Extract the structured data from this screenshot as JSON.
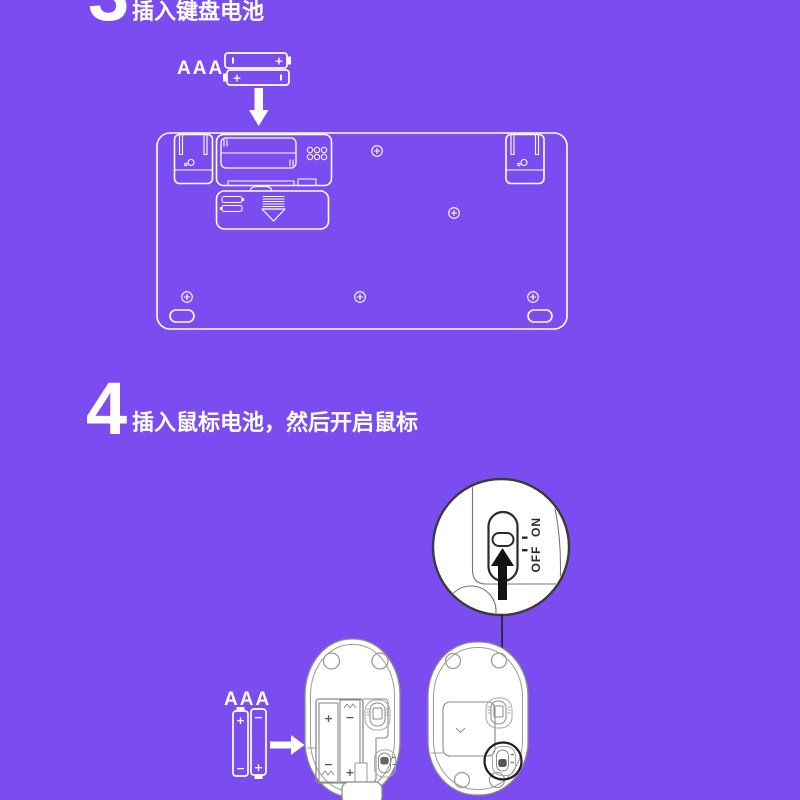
{
  "steps": {
    "step3": {
      "number": "3",
      "title": "插入键盘电池"
    },
    "step4": {
      "number": "4",
      "title": "插入鼠标电池，然后开启鼠标"
    }
  },
  "labels": {
    "keyboard_battery_type": "AAA",
    "mouse_battery_type": "AAA",
    "plus": "+",
    "minus": "−",
    "switch_off": "OFF",
    "switch_on": "ON"
  },
  "colors": {
    "background": "#7B4DF0",
    "line_art": "#FFFFFF",
    "mouse_outline": "#8D8D8D",
    "callout_outline": "#3B3B3B",
    "arrow_black": "#141414"
  }
}
